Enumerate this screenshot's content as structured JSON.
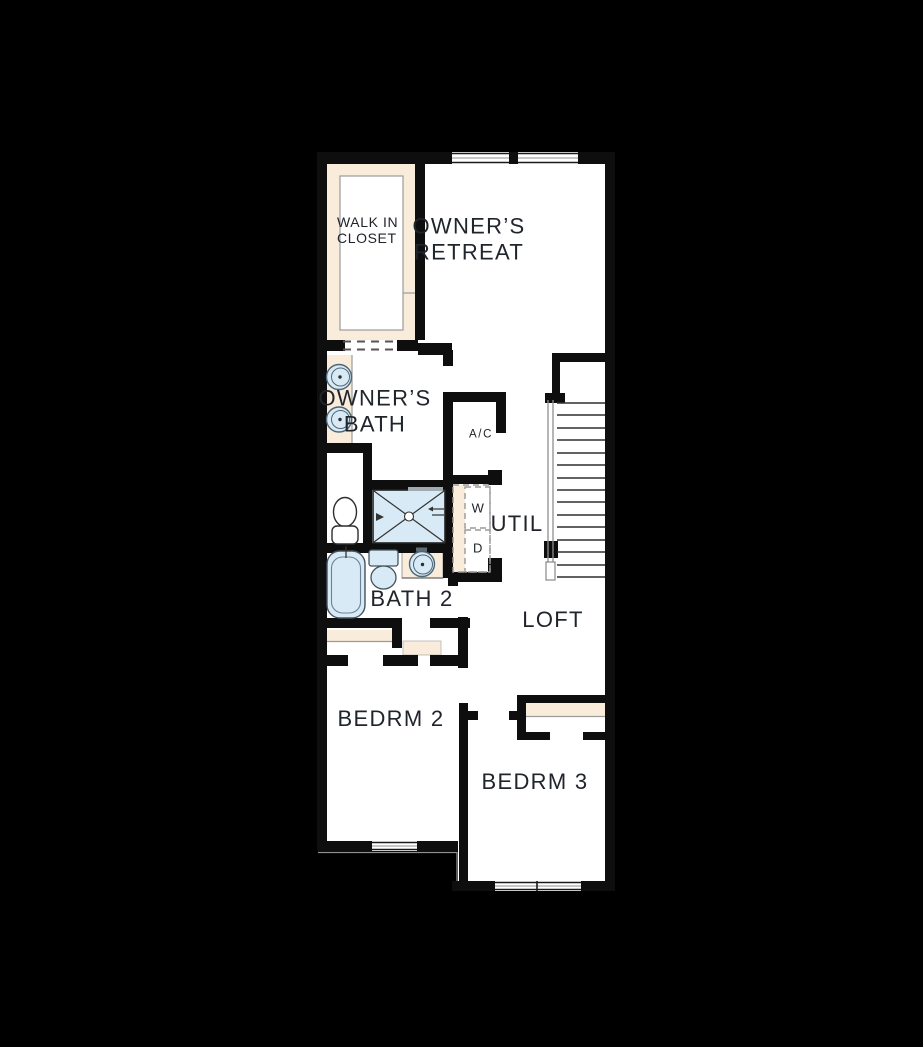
{
  "floorplan": {
    "colors": {
      "background": "#000000",
      "wall": "#0e0e0e",
      "floor": "#ffffff",
      "casework": "#f9ecda",
      "fixture": "#d8eaf5",
      "detail_line": "#8f8f8f",
      "label_text": "#20242b"
    },
    "rooms": {
      "walk_in_closet": "WALK IN\nCLOSET",
      "owners_retreat": "OWNER’S\nRETREAT",
      "owners_bath": "OWNER’S\nBATH",
      "ac": "A/C",
      "util": "UTIL",
      "bath2": "BATH 2",
      "loft": "LOFT",
      "bedrm2": "BEDRM 2",
      "bedrm3": "BEDRM 3"
    },
    "appliances": {
      "washer": "W",
      "dryer": "D"
    }
  }
}
